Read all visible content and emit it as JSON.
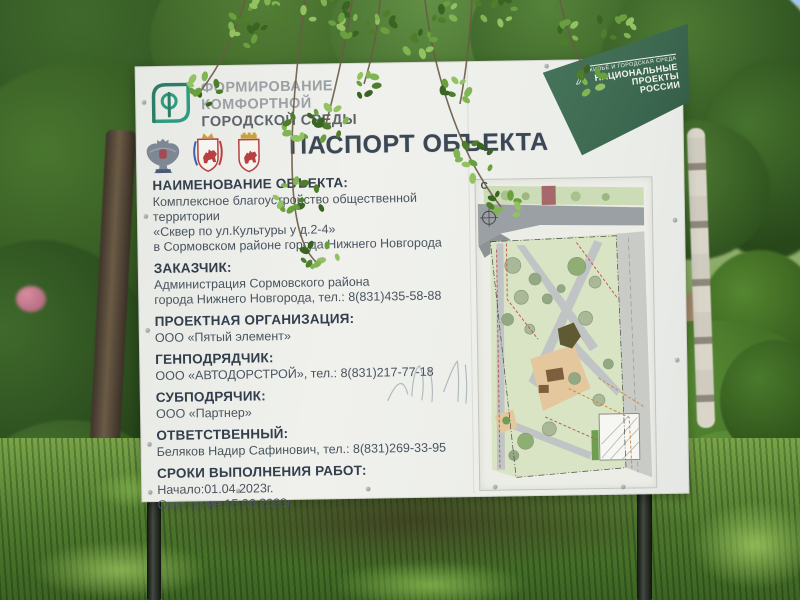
{
  "sign": {
    "program_logo": {
      "icon": "comfortable-urban-environment-logo",
      "lines": [
        "ФОРМИРОВАНИЕ",
        "КОМФОРТНОЙ",
        "ГОРОДСКОЙ СРЕДЫ"
      ]
    },
    "emblems": [
      {
        "icon": "minstroy-russia-eagle-emblem"
      },
      {
        "icon": "nizhny-novgorod-region-coat-of-arms"
      },
      {
        "icon": "nizhny-novgorod-city-coat-of-arms"
      }
    ],
    "title": "ПАСПОРТ ОБЪЕКТА",
    "national_project_banner": {
      "icon": "national-projects-russia-logo",
      "tagline": "ЖИЛЬЁ И ГОРОДСКАЯ СРЕДА",
      "lines": [
        "НАЦИОНАЛЬНЫЕ",
        "ПРОЕКТЫ",
        "РОССИИ"
      ]
    },
    "sections": [
      {
        "heading": "НАИМЕНОВАНИЕ ОБЪЕКТА:",
        "lines": [
          "Комплексное благоустройство общественной территории",
          "«Сквер по ул.Культуры у д.2-4»",
          "в Сормовском районе города Нижнего Новгорода"
        ]
      },
      {
        "heading": "ЗАКАЗЧИК:",
        "lines": [
          "Администрация Сормовского района",
          "города Нижнего Новгорода, тел.: 8(831)435-58-88"
        ]
      },
      {
        "heading": "ПРОЕКТНАЯ ОРГАНИЗАЦИЯ:",
        "lines": [
          "ООО «Пятый элемент»"
        ]
      },
      {
        "heading": "ГЕНПОДРЯДЧИК:",
        "lines": [
          "ООО «АВТОДОРСТРОЙ», тел.: 8(831)217-77-18"
        ]
      },
      {
        "heading": "СУБПОДРЯЧИК:",
        "lines": [
          "ООО «Партнер»"
        ]
      },
      {
        "heading": "ОТВЕТСТВЕННЫЙ:",
        "lines": [
          "Беляков Надир Сафинович, тел.: 8(831)269-33-95"
        ]
      },
      {
        "heading": "СРОКИ ВЫПОЛНЕНИЯ РАБОТ:",
        "lines": [
          "Начало:01.04.2023г.",
          "Окончание:15.06.2023г."
        ]
      }
    ],
    "site_plan": {
      "north_label": "С"
    }
  },
  "colors": {
    "banner_green": "#3e6a52",
    "logo_teal": "#2f9c82",
    "title_text": "#3c4756",
    "heading_text": "#333e4c",
    "body_text": "#4a545e",
    "board": "#f0f1ed",
    "map_lawn": "#d8e4c4",
    "map_road": "#9aa0a3",
    "playground_tan": "#e5c79d"
  }
}
